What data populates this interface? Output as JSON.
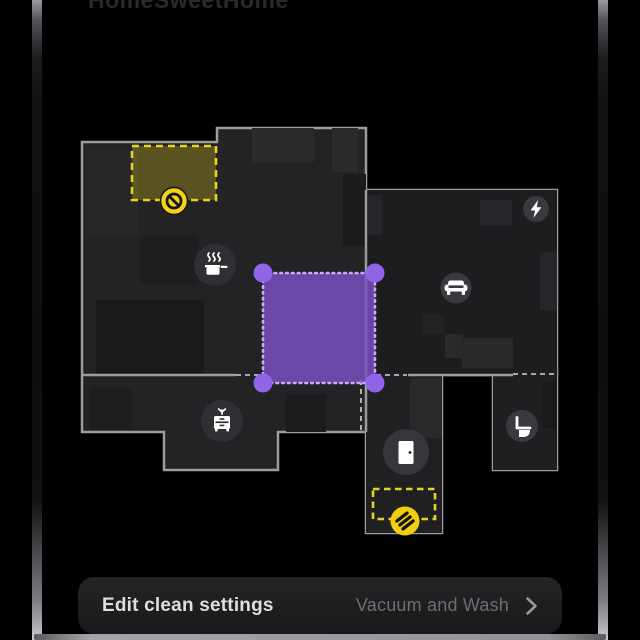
{
  "title": "HomeSweetHome",
  "bottom_bar": {
    "edit_label": "Edit clean settings",
    "mode_label": "Vacuum and Wash"
  },
  "map": {
    "zones": [
      {
        "id": "no-go-zone",
        "style": "dashed-yellow",
        "filled": true,
        "icon": "no-entry-icon"
      },
      {
        "id": "zone-clean",
        "style": "dotted-purple",
        "handles": 4
      },
      {
        "id": "no-mop-zone",
        "style": "dashed-yellow",
        "filled": false,
        "icon": "no-mop-stripes-icon"
      }
    ],
    "icons": [
      {
        "name": "no-entry-icon"
      },
      {
        "name": "cooking-pot-icon"
      },
      {
        "name": "couch-icon"
      },
      {
        "name": "lightning-bolt-icon"
      },
      {
        "name": "dresser-icon"
      },
      {
        "name": "door-icon"
      },
      {
        "name": "toilet-icon"
      },
      {
        "name": "no-mop-stripes-icon"
      },
      {
        "name": "chevron-right-icon"
      }
    ],
    "colors": {
      "accent_purple": "#7B50C5",
      "purple_handle": "#9164EA",
      "zone_yellow": "#E8D322",
      "icon_yellow": "#F2D414",
      "outline_gray": "#9C9C9C",
      "room_fill": "#232325"
    }
  }
}
